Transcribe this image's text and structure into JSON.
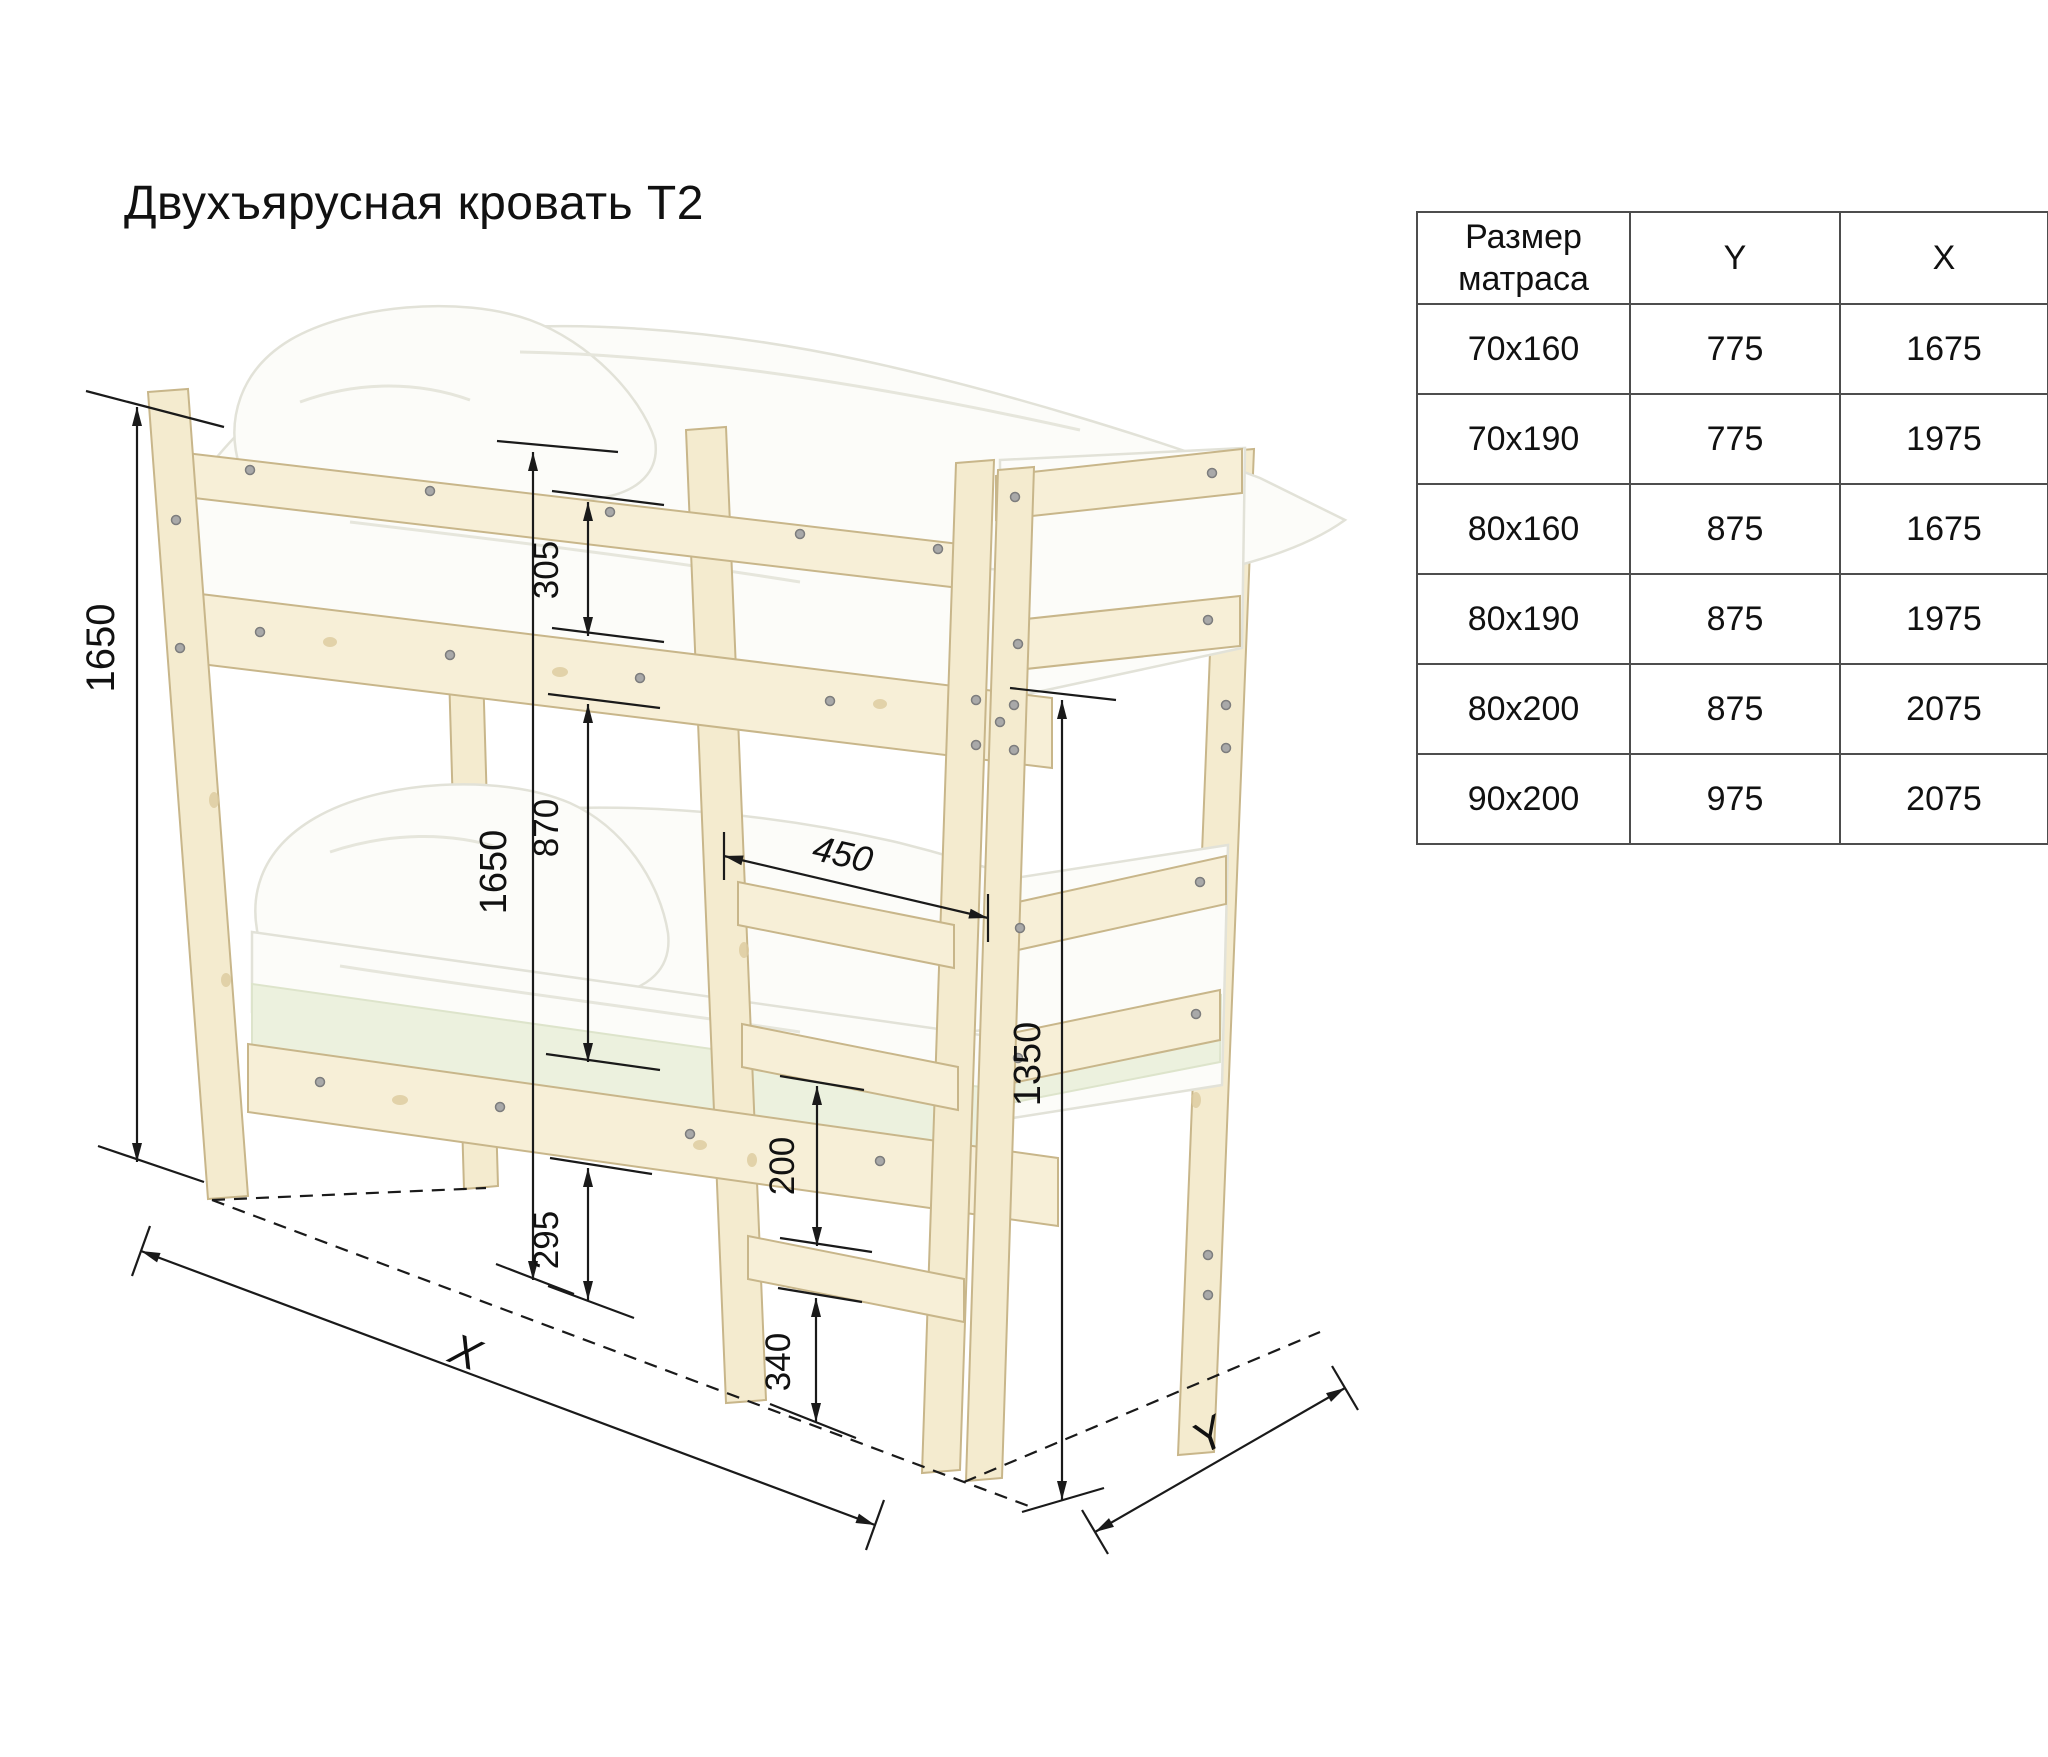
{
  "title": "Двухъярусная кровать Т2",
  "table": {
    "headers": {
      "size": "Размер матраса",
      "y": "Y",
      "x": "X"
    },
    "rows": [
      {
        "size": "70x160",
        "y": "775",
        "x": "1675"
      },
      {
        "size": "70x190",
        "y": "775",
        "x": "1975"
      },
      {
        "size": "80x160",
        "y": "875",
        "x": "1675"
      },
      {
        "size": "80x190",
        "y": "875",
        "x": "1975"
      },
      {
        "size": "80x200",
        "y": "875",
        "x": "2075"
      },
      {
        "size": "90x200",
        "y": "975",
        "x": "2075"
      }
    ]
  },
  "diagram": {
    "dimensions": {
      "overall_height": "1650",
      "guard_rail_height": "305",
      "bunk_gap": "870",
      "inner_height": "1650",
      "ladder_width": "450",
      "rung_spacing": "200",
      "rail_to_floor": "295",
      "bottom_rung_height": "340",
      "upper_bunk_clearance": "1350",
      "length_axis": "X",
      "depth_axis": "Y"
    },
    "palette": {
      "wood": "#f4ebcf",
      "wood_stroke": "#c8b68a",
      "bedding": "#fcfcf9",
      "mattress_green": "#ecf1de",
      "dimension_line": "#1a1a1a",
      "table_border": "#4d4d4d",
      "background": "#ffffff"
    }
  }
}
